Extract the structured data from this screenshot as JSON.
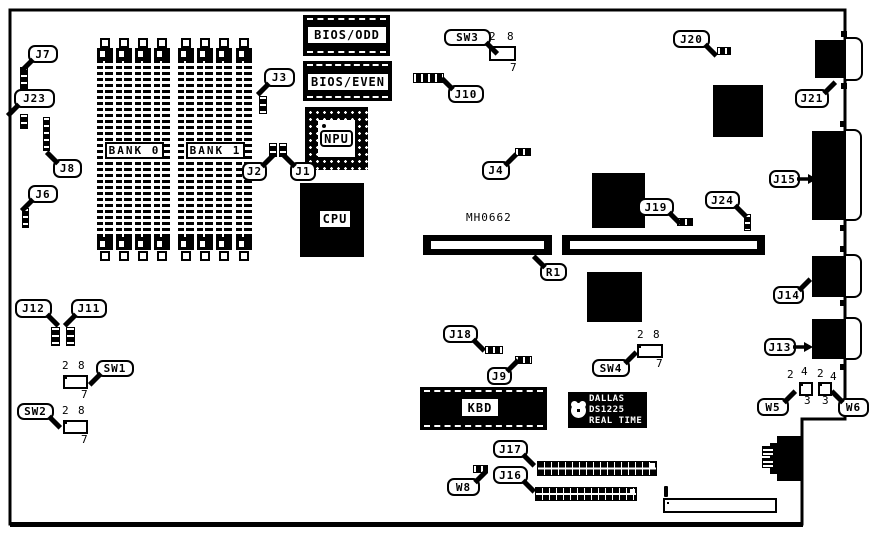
{
  "figure": "motherboard-component-location-diagram",
  "colors": {
    "ink": "#000000",
    "paper": "#ffffff"
  },
  "outline": {
    "points": "10,10 845,10 845,419 802,419 802,524 10,524",
    "bottom_bar": [
      10,
      522,
      793,
      5
    ]
  },
  "memory": {
    "strip_xs": [
      97,
      116,
      135,
      154,
      178,
      197,
      216,
      236
    ],
    "strip_w": 16,
    "body_y": 48,
    "body_h": 202,
    "sq_top_y": 38,
    "sq_bot_y": 251,
    "bank_labels": [
      {
        "text": "BANK 0",
        "r": [
          105,
          142,
          59,
          17
        ]
      },
      {
        "text": "BANK 1",
        "r": [
          186,
          142,
          59,
          17
        ]
      }
    ]
  },
  "chips": [
    {
      "name": "bios-odd-chip",
      "type": "dip",
      "label": "BIOS/ODD",
      "r": [
        303,
        15,
        87,
        41
      ],
      "label_box": [
        308,
        27,
        78,
        16
      ]
    },
    {
      "name": "bios-even-chip",
      "type": "dip",
      "label": "BIOS/EVEN",
      "r": [
        303,
        61,
        89,
        40
      ],
      "label_box": [
        308,
        74,
        80,
        16
      ]
    },
    {
      "name": "npu-chip",
      "type": "pga",
      "label": "NPU",
      "r": [
        305,
        107,
        63,
        63
      ],
      "label_box": [
        320,
        130,
        33,
        17
      ]
    },
    {
      "name": "cpu-chip",
      "type": "solid",
      "label": "CPU",
      "r": [
        300,
        183,
        64,
        74
      ],
      "label_box": [
        320,
        211,
        30,
        16
      ]
    },
    {
      "name": "kbd-chip",
      "type": "dip",
      "label": "KBD",
      "r": [
        420,
        387,
        127,
        43
      ],
      "label_box": [
        462,
        399,
        36,
        17
      ]
    },
    {
      "name": "chip-1",
      "type": "solid",
      "label": "",
      "r": [
        713,
        85,
        50,
        52
      ]
    },
    {
      "name": "chip-2",
      "type": "solid",
      "label": "",
      "r": [
        592,
        173,
        53,
        55
      ]
    },
    {
      "name": "chip-3",
      "type": "solid",
      "label": "",
      "r": [
        587,
        272,
        55,
        50
      ]
    }
  ],
  "slots": [
    {
      "name": "slot-left",
      "r": [
        423,
        235,
        129,
        20
      ]
    },
    {
      "name": "slot-right",
      "r": [
        562,
        235,
        203,
        20
      ]
    }
  ],
  "slot_label": {
    "text": "MH0662"
  },
  "dallas": {
    "lines": [
      "DALLAS",
      "DS1225",
      "REAL TIME"
    ]
  },
  "headers": [
    {
      "name": "j10-header",
      "r": [
        413,
        73,
        31,
        10
      ],
      "dir": "h"
    },
    {
      "name": "j4-header",
      "r": [
        515,
        148,
        16,
        8
      ],
      "dir": "h"
    },
    {
      "name": "j20-header",
      "r": [
        717,
        47,
        14,
        8
      ],
      "dir": "h"
    },
    {
      "name": "j19-header",
      "r": [
        677,
        218,
        16,
        8
      ],
      "dir": "h"
    },
    {
      "name": "j18-header",
      "r": [
        485,
        346,
        18,
        8
      ],
      "dir": "h"
    },
    {
      "name": "j9-header",
      "r": [
        515,
        356,
        17,
        8
      ],
      "dir": "h"
    },
    {
      "name": "w8-header",
      "r": [
        473,
        465,
        15,
        8
      ],
      "dir": "h"
    },
    {
      "name": "j7-jumper",
      "r": [
        20,
        67,
        8,
        23
      ],
      "dir": "v"
    },
    {
      "name": "j23-jumper",
      "r": [
        20,
        114,
        8,
        15
      ],
      "dir": "v"
    },
    {
      "name": "j8-header",
      "r": [
        43,
        117,
        7,
        34
      ],
      "dir": "v"
    },
    {
      "name": "j6-jumper",
      "r": [
        22,
        208,
        7,
        20
      ],
      "dir": "v"
    },
    {
      "name": "j3-header",
      "r": [
        259,
        96,
        8,
        18
      ],
      "dir": "v"
    },
    {
      "name": "j24-jumper",
      "r": [
        744,
        214,
        7,
        17
      ],
      "dir": "v"
    },
    {
      "name": "j12-jumper",
      "r": [
        51,
        327,
        9,
        19
      ],
      "dir": "v"
    },
    {
      "name": "j11-jumper",
      "r": [
        66,
        327,
        9,
        19
      ],
      "dir": "v"
    },
    {
      "name": "j2-jumper",
      "r": [
        269,
        143,
        8,
        14
      ],
      "dir": "v"
    },
    {
      "name": "j1-jumper",
      "r": [
        279,
        143,
        8,
        14
      ],
      "dir": "v"
    }
  ],
  "long_headers": [
    {
      "name": "j17-header",
      "r": [
        537,
        461,
        120,
        15
      ]
    },
    {
      "name": "j16-header",
      "r": [
        535,
        487,
        102,
        14
      ]
    }
  ],
  "dip_switches": [
    {
      "name": "sw3-block",
      "r": [
        489,
        46,
        27,
        15
      ]
    },
    {
      "name": "sw1-block",
      "r": [
        63,
        375,
        25,
        14
      ]
    },
    {
      "name": "sw2-block",
      "r": [
        63,
        420,
        25,
        14
      ]
    },
    {
      "name": "sw4-block",
      "r": [
        637,
        344,
        26,
        14
      ]
    }
  ],
  "w_jumpers": [
    {
      "name": "w5-block",
      "r": [
        799,
        382,
        14,
        14
      ]
    },
    {
      "name": "w6-block",
      "r": [
        818,
        382,
        14,
        14
      ]
    }
  ],
  "edge_connectors": [
    {
      "name": "j21-connector",
      "black": [
        815,
        40,
        29,
        38
      ],
      "white": [
        844,
        37,
        19,
        44
      ]
    },
    {
      "name": "j15-connector",
      "black": [
        812,
        131,
        32,
        89
      ],
      "white": [
        844,
        129,
        18,
        92
      ]
    },
    {
      "name": "j14-connector",
      "black": [
        812,
        256,
        32,
        41
      ],
      "white": [
        844,
        254,
        18,
        44
      ]
    },
    {
      "name": "j13-connector",
      "black": [
        812,
        319,
        32,
        40
      ],
      "white": [
        844,
        317,
        18,
        43
      ]
    }
  ],
  "screws": [
    [
      841,
      31
    ],
    [
      841,
      83
    ],
    [
      840,
      121
    ],
    [
      840,
      225
    ],
    [
      840,
      246
    ],
    [
      840,
      300
    ],
    [
      840,
      364
    ]
  ],
  "power_connector": {
    "pins_row": [
      664,
      486,
      113,
      12
    ],
    "pin_count": 12,
    "box": [
      663,
      498,
      114,
      15
    ],
    "box_cells": 12
  },
  "din_connector": {
    "main": [
      777,
      436,
      24,
      45
    ],
    "mid": [
      770,
      443,
      31,
      31
    ],
    "pins": [
      [
        762,
        446,
        12,
        10
      ],
      [
        762,
        458,
        12,
        10
      ]
    ]
  },
  "callouts": [
    {
      "label": "J7",
      "r": [
        28,
        45,
        30,
        18
      ],
      "tail": "bl"
    },
    {
      "label": "J23",
      "r": [
        14,
        89,
        41,
        19
      ],
      "tail": "bl"
    },
    {
      "label": "J8",
      "r": [
        53,
        159,
        29,
        19
      ],
      "tail": "tl"
    },
    {
      "label": "J6",
      "r": [
        28,
        185,
        30,
        18
      ],
      "tail": "bl"
    },
    {
      "label": "J3",
      "r": [
        264,
        68,
        31,
        19
      ],
      "tail": "bl"
    },
    {
      "label": "J2",
      "r": [
        242,
        162,
        25,
        19
      ],
      "tail": "tr"
    },
    {
      "label": "J1",
      "r": [
        290,
        162,
        26,
        19
      ],
      "tail": "tl"
    },
    {
      "label": "J12",
      "r": [
        15,
        299,
        37,
        19
      ],
      "tail": "br"
    },
    {
      "label": "J11",
      "r": [
        71,
        299,
        36,
        19
      ],
      "tail": "bl"
    },
    {
      "label": "SW1",
      "r": [
        96,
        360,
        38,
        17
      ],
      "tail": "bl"
    },
    {
      "label": "SW2",
      "r": [
        17,
        403,
        37,
        17
      ],
      "tail": "br"
    },
    {
      "label": "SW3",
      "r": [
        444,
        29,
        47,
        17
      ],
      "tail": "br"
    },
    {
      "label": "J10",
      "r": [
        448,
        85,
        36,
        18
      ],
      "tail": "tl"
    },
    {
      "label": "J4",
      "r": [
        482,
        161,
        28,
        19
      ],
      "tail": "tr"
    },
    {
      "label": "J20",
      "r": [
        673,
        30,
        37,
        18
      ],
      "tail": "br"
    },
    {
      "label": "J21",
      "r": [
        795,
        89,
        34,
        19
      ],
      "tail": "tr"
    },
    {
      "label": "J15",
      "r": [
        769,
        170,
        31,
        18
      ],
      "tail": "rr"
    },
    {
      "label": "J14",
      "r": [
        773,
        286,
        31,
        18
      ],
      "tail": "tr"
    },
    {
      "label": "J13",
      "r": [
        764,
        338,
        32,
        18
      ],
      "tail": "rr"
    },
    {
      "label": "J19",
      "r": [
        638,
        198,
        36,
        18
      ],
      "tail": "br"
    },
    {
      "label": "J24",
      "r": [
        705,
        191,
        35,
        18
      ],
      "tail": "br"
    },
    {
      "label": "R1",
      "r": [
        540,
        263,
        27,
        18
      ],
      "tail": "tl"
    },
    {
      "label": "J18",
      "r": [
        443,
        325,
        35,
        18
      ],
      "tail": "br"
    },
    {
      "label": "J9",
      "r": [
        487,
        367,
        25,
        18
      ],
      "tail": "tr"
    },
    {
      "label": "SW4",
      "r": [
        592,
        359,
        38,
        18
      ],
      "tail": "tr"
    },
    {
      "label": "W5",
      "r": [
        757,
        398,
        32,
        18
      ],
      "tail": "tr"
    },
    {
      "label": "W6",
      "r": [
        838,
        398,
        31,
        19
      ],
      "tail": "tl"
    },
    {
      "label": "J17",
      "r": [
        493,
        440,
        35,
        18
      ],
      "tail": "br"
    },
    {
      "label": "W8",
      "r": [
        447,
        478,
        33,
        18
      ],
      "tail": "tr"
    },
    {
      "label": "J16",
      "r": [
        493,
        466,
        35,
        18
      ],
      "tail": "br"
    }
  ],
  "tiny_labels": [
    {
      "t": "2",
      "x": 489,
      "y": 32
    },
    {
      "t": "8",
      "x": 507,
      "y": 32
    },
    {
      "t": "7",
      "x": 510,
      "y": 63
    },
    {
      "t": "2",
      "x": 62,
      "y": 361
    },
    {
      "t": "8",
      "x": 78,
      "y": 361
    },
    {
      "t": "7",
      "x": 81,
      "y": 390
    },
    {
      "t": "2",
      "x": 62,
      "y": 406
    },
    {
      "t": "8",
      "x": 78,
      "y": 406
    },
    {
      "t": "7",
      "x": 81,
      "y": 435
    },
    {
      "t": "2",
      "x": 637,
      "y": 330
    },
    {
      "t": "8",
      "x": 653,
      "y": 330
    },
    {
      "t": "7",
      "x": 656,
      "y": 359
    },
    {
      "t": "2",
      "x": 787,
      "y": 370
    },
    {
      "t": "4",
      "x": 801,
      "y": 367
    },
    {
      "t": "3",
      "x": 804,
      "y": 396
    },
    {
      "t": "2",
      "x": 817,
      "y": 369
    },
    {
      "t": "4",
      "x": 830,
      "y": 372
    },
    {
      "t": "3",
      "x": 822,
      "y": 396
    }
  ]
}
